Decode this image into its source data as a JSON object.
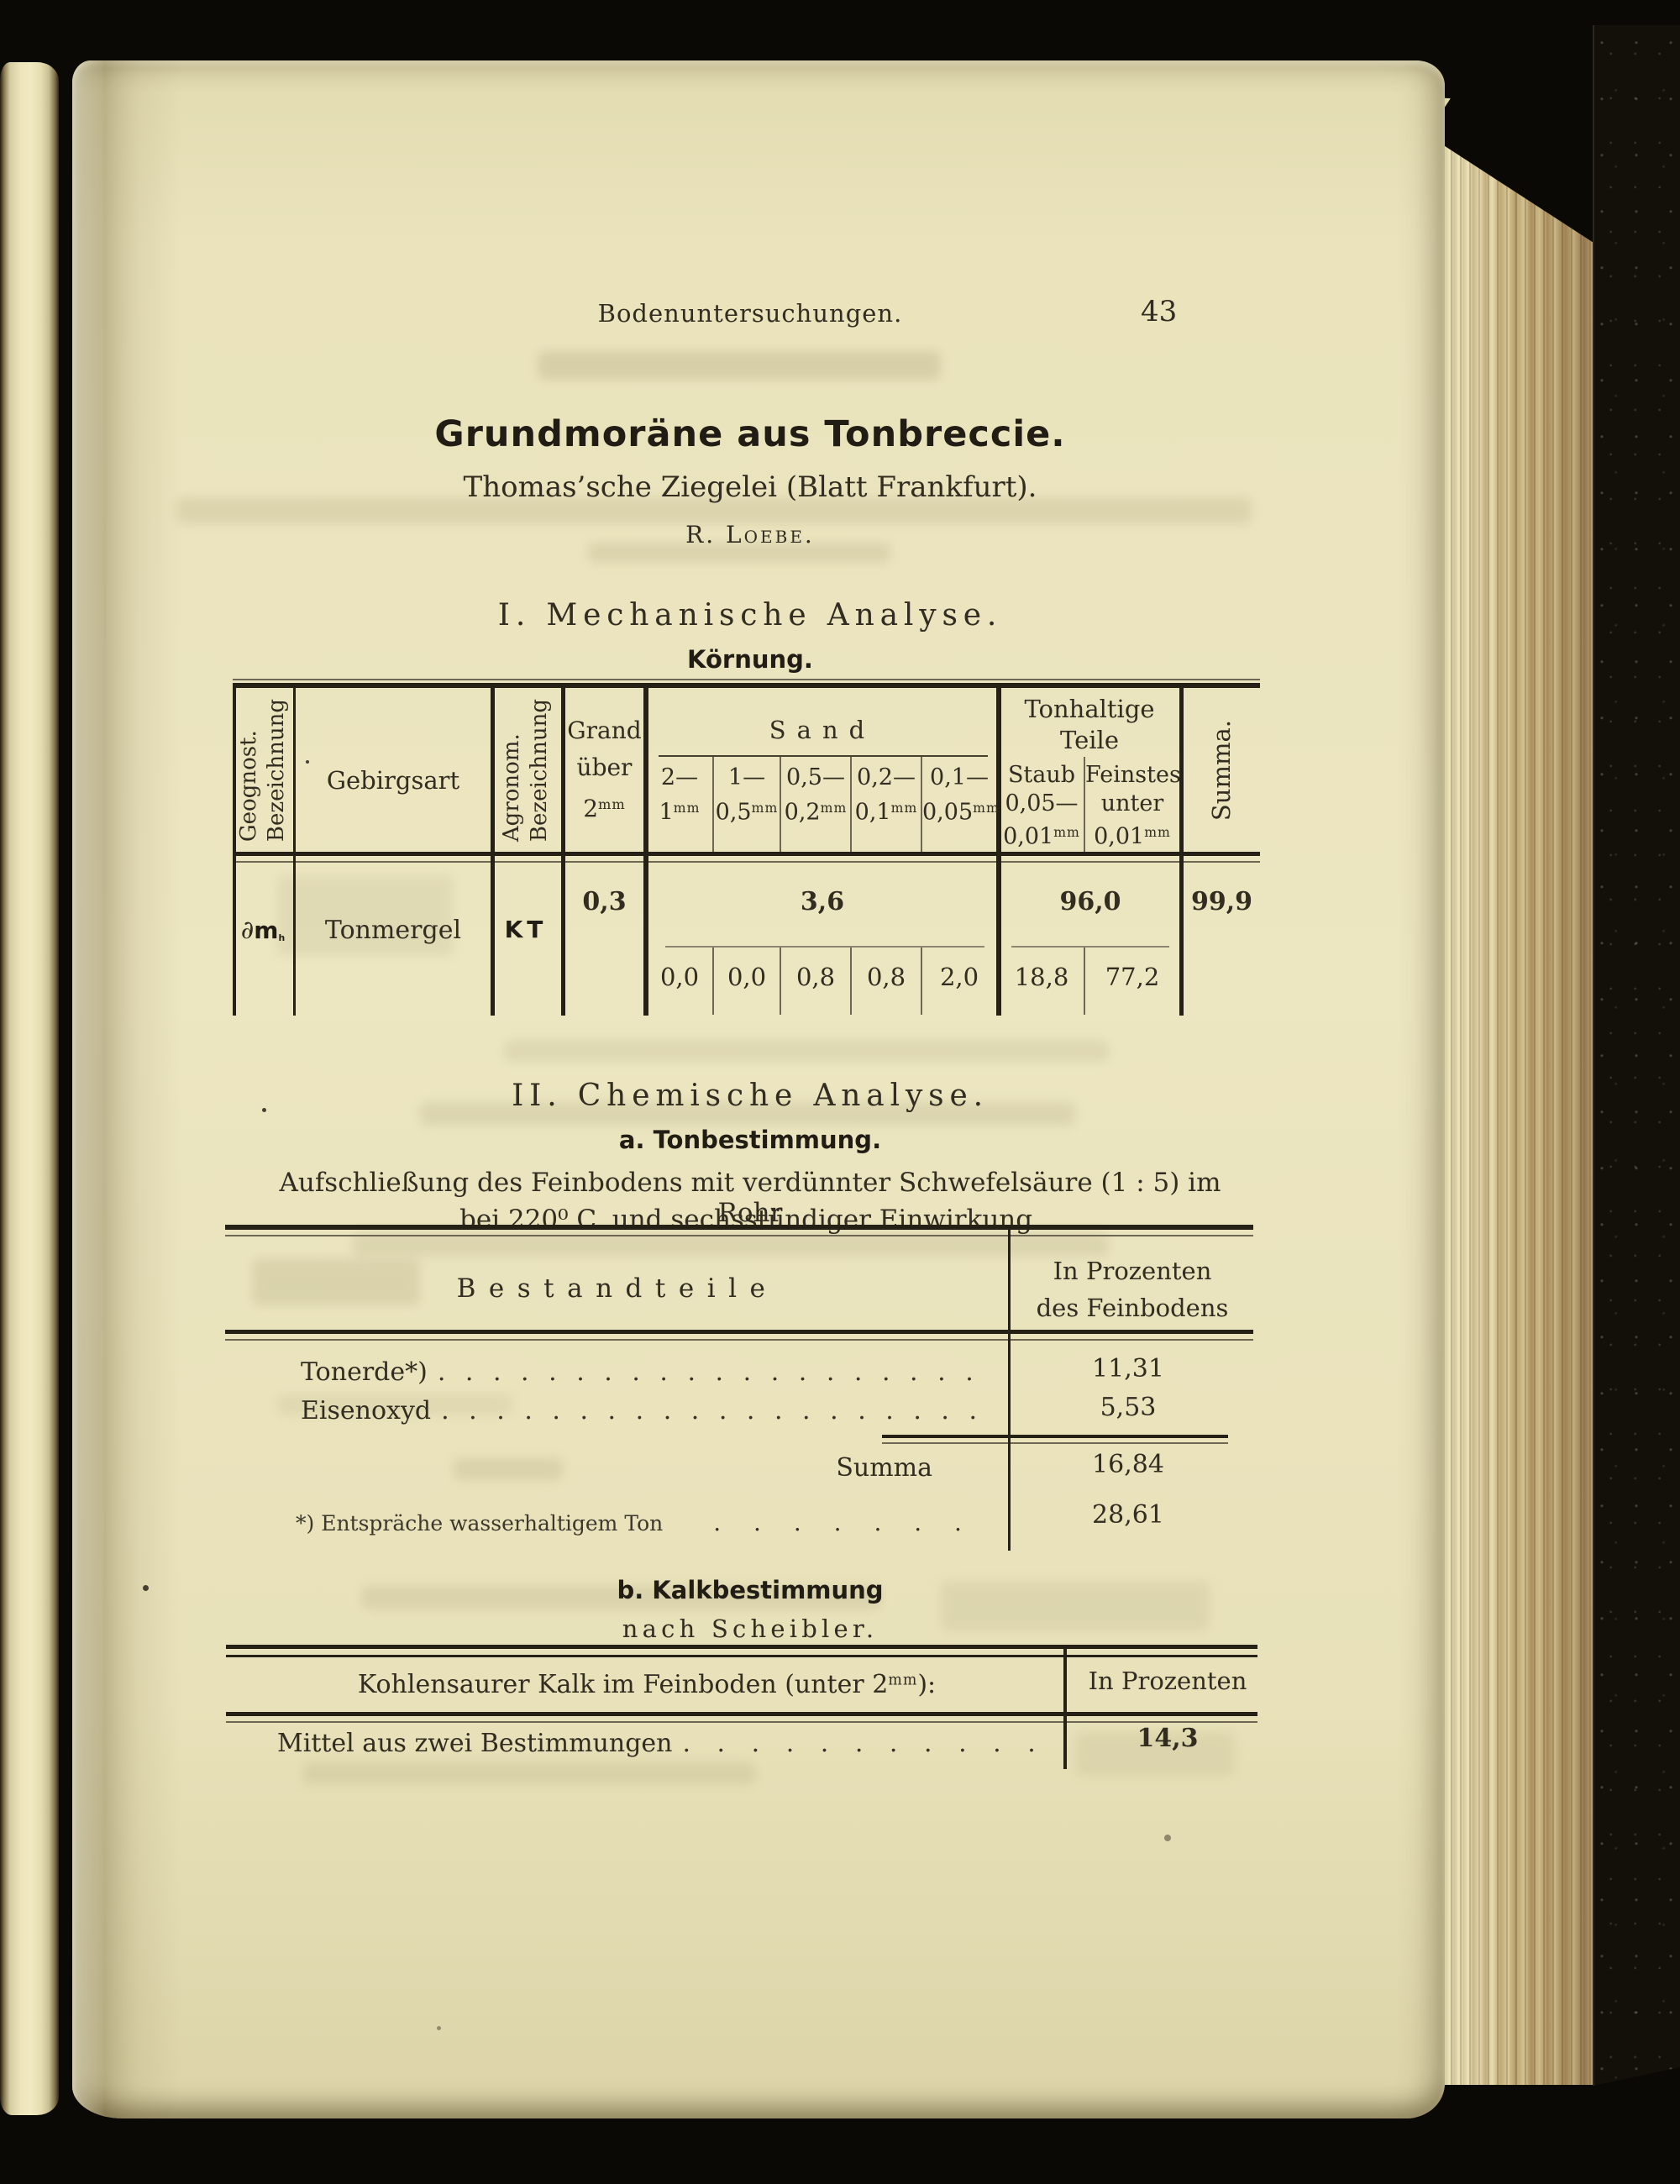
{
  "page_header": {
    "title": "Bodenuntersuchungen.",
    "page_number": "43"
  },
  "title_block": {
    "title": "Grundmoräne aus Tonbreccie.",
    "subtitle": "Thomas’sche Ziegelei (Blatt Frankfurt).",
    "author": "R. Loebe."
  },
  "section_mech": {
    "heading": "I. Mechanische Analyse.",
    "subheading": "Körnung."
  },
  "mech_table": {
    "geognost_l1": "Geognost.",
    "geognost_l2": "Bezeichnung",
    "gebirgsart": "Gebirgsart",
    "agronom_l1": "Agronom.",
    "agronom_l2": "Bezeichnung",
    "grand_l1": "Grand",
    "grand_l2": "über",
    "grand_num": "2",
    "unit_mm": "mm",
    "sand": "Sand",
    "sand_cols": [
      {
        "a": "2—",
        "b": "1"
      },
      {
        "a": "1—",
        "b": "0,5"
      },
      {
        "a": "0,5—",
        "b": "0,2"
      },
      {
        "a": "0,2—",
        "b": "0,1"
      },
      {
        "a": "0,1—",
        "b": "0,05"
      }
    ],
    "ton_l1": "Tonhaltige",
    "ton_l2": "Teile",
    "staub_l1": "Staub",
    "staub_l2": "0,05—",
    "staub_l3": "0,01",
    "fein_l1": "Feinstes",
    "fein_l2": "unter",
    "fein_l3": "0,01",
    "summa_label": "Summa.",
    "row": {
      "geo_d": "∂",
      "geo_m": "m",
      "geo_sub": "h",
      "gebirgsart": "Tonmergel",
      "agronom": "KT",
      "grand": "0,3",
      "sand_total": "3,6",
      "sand_values": [
        "0,0",
        "0,0",
        "0,8",
        "0,8",
        "2,0"
      ],
      "ton_total": "96,0",
      "ton_values": [
        "18,8",
        "77,2"
      ],
      "summa": "99,9"
    }
  },
  "section_chem": {
    "heading": "II. Chemische Analyse.",
    "sub": "a. Tonbestimmung.",
    "desc1": "Aufschließung des Feinbodens mit verdünnter Schwefelsäure (1 : 5) im Rohr",
    "desc2": "bei 220⁰ C. und sechsstündiger Einwirkung."
  },
  "chem_table": {
    "header_left": "Bestandteile",
    "header_right1": "In Prozenten",
    "header_right2": "des Feinbodens",
    "row1_label": "Tonerde*)",
    "row1_value": "11,31",
    "row2_label": "Eisenoxyd",
    "row2_value": "5,53",
    "summa_label": "Summa",
    "summa_value": "16,84",
    "footnote_label": "*) Entspräche wasserhaltigem Ton",
    "footnote_value": "28,61"
  },
  "section_kalk": {
    "sub": "b. Kalkbestimmung",
    "method": "nach Scheibler."
  },
  "kalk_table": {
    "header_left_a": "Kohlensaurer Kalk im Feinboden (unter 2",
    "header_left_b": "):",
    "header_right": "In Prozenten",
    "row_label": "Mittel aus zwei Bestimmungen",
    "row_value": "14,3"
  },
  "leaders": {
    "long": ". . . . . . . . . . . . . . . . . . . . . . . . . . . . . . . . . . .",
    "short": ". . . . . . . . . . . . ."
  }
}
